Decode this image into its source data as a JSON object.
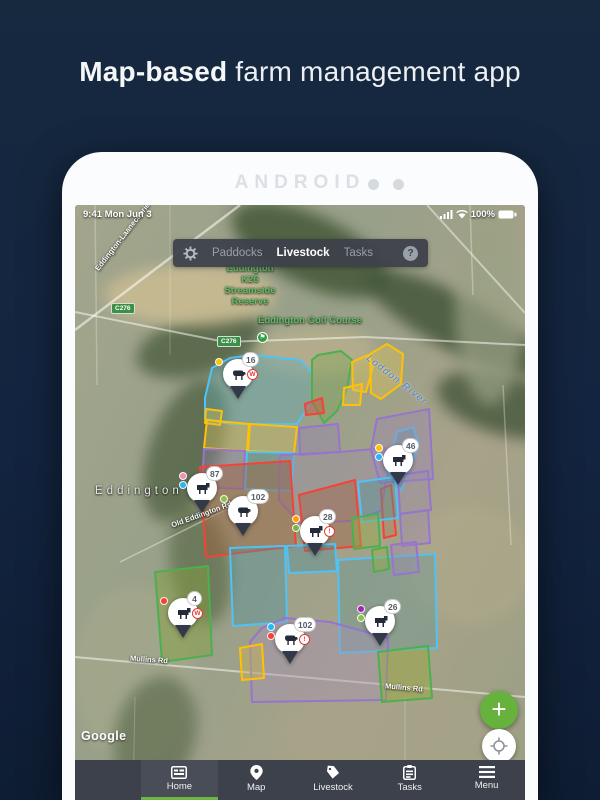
{
  "page": {
    "title_bold": "Map-based",
    "title_rest": " farm management app"
  },
  "device": {
    "brand": "ANDROID"
  },
  "status_bar": {
    "time_date": "9:41  Mon Jun 3",
    "battery_pct": "100%"
  },
  "top_nav": {
    "help": "?",
    "tabs": [
      {
        "label": "Paddocks",
        "active": false
      },
      {
        "label": "Livestock",
        "active": true
      },
      {
        "label": "Tasks",
        "active": false
      }
    ]
  },
  "map": {
    "labels": {
      "reserve_lines": [
        "Eddington",
        "K26",
        "Streamside",
        "Reserve"
      ],
      "golf_course": "Eddington Golf Course",
      "road_shield_1": "C276",
      "road_shield_2": "C276",
      "road_laanecoorie": "Eddington-Laanecoorie Rd",
      "river": "Loddon River",
      "place": "Eddington",
      "road_old_eddington": "Old Eddington Rd",
      "road_mullins_1": "Mullins Rd",
      "road_mullins_2": "Mullins Rd",
      "attribution": "Google"
    },
    "palette": {
      "cyan": "#4FC3F7",
      "green": "#4CAF50",
      "yellow": "#FFC107",
      "purple": "#9575CD",
      "red": "#F44336"
    },
    "paddocks": [
      {
        "points": "130,193 137,163 155,153 177,150 225,155 237,168 237,196 222,219 156,219 130,214",
        "stroke": "cyan",
        "fill": "rgba(100,170,180,0.40)"
      },
      {
        "points": "237,168 237,155 243,150 266,146 277,155 272,184 262,206 249,218 237,196",
        "stroke": "green",
        "fill": "rgba(120,165,75,0.35)"
      },
      {
        "points": "277,157 293,150 298,162 291,187 278,185",
        "stroke": "yellow",
        "fill": "rgba(210,190,90,0.45)"
      },
      {
        "points": "295,149 312,139 328,149 326,179 306,194 296,188",
        "stroke": "yellow",
        "fill": "rgba(210,190,90,0.45)"
      },
      {
        "points": "269,183 287,179 285,200 268,200",
        "stroke": "yellow",
        "fill": "rgba(210,190,90,0.40)"
      },
      {
        "points": "230,199 247,193 249,208 231,210",
        "stroke": "red",
        "fill": "rgba(200,90,70,0.50)"
      },
      {
        "points": "131,204 147,206 145,220 130,218",
        "stroke": "yellow",
        "fill": "rgba(210,190,90,0.40)"
      },
      {
        "points": "132,215 174,219 172,246 129,243",
        "stroke": "yellow",
        "fill": "rgba(205,185,95,0.45)"
      },
      {
        "points": "175,219 222,222 219,248 173,246",
        "stroke": "yellow",
        "fill": "rgba(205,185,95,0.45)"
      },
      {
        "points": "224,223 263,219 265,247 225,250",
        "stroke": "purple",
        "fill": "rgba(150,130,185,0.38)"
      },
      {
        "points": "129,244 170,246 168,284 127,282",
        "stroke": "purple",
        "fill": "rgba(150,130,185,0.32)"
      },
      {
        "points": "172,247 219,248 217,286 170,284",
        "stroke": "cyan",
        "fill": "rgba(80,145,155,0.42)"
      },
      {
        "points": "205,250 265,247 310,243 313,266 306,306 274,316 224,318 204,295",
        "stroke": "purple",
        "fill": "rgba(155,135,175,0.35)"
      },
      {
        "points": "322,227 338,222 344,240 326,286 312,266",
        "stroke": "cyan",
        "fill": "rgba(80,145,155,0.40)"
      },
      {
        "points": "302,214 354,204 358,274 305,278 296,245",
        "stroke": "purple",
        "fill": "rgba(155,135,180,0.42)"
      },
      {
        "points": "125,262 215,256 221,341 131,352",
        "stroke": "red",
        "fill": "rgba(160,95,60,0.45)"
      },
      {
        "points": "224,290 280,275 286,341 230,346",
        "stroke": "red",
        "fill": "rgba(160,95,60,0.40)"
      },
      {
        "points": "306,284 316,280 321,330 309,333",
        "stroke": "red",
        "fill": "rgba(180,120,80,0.35)"
      },
      {
        "points": "283,277 320,272 323,313 287,317",
        "stroke": "cyan",
        "fill": "rgba(80,145,155,0.40)"
      },
      {
        "points": "323,270 353,266 356,305 325,309",
        "stroke": "purple",
        "fill": "rgba(155,135,180,0.35)"
      },
      {
        "points": "277,313 303,309 305,341 279,344",
        "stroke": "green",
        "fill": "rgba(150,170,70,0.45)"
      },
      {
        "points": "325,309 353,305 355,338 327,341",
        "stroke": "purple",
        "fill": "rgba(155,135,180,0.35)"
      },
      {
        "points": "155,343 210,341 212,417 158,421",
        "stroke": "cyan",
        "fill": "rgba(80,145,155,0.40)"
      },
      {
        "points": "212,341 260,339 262,366 214,368",
        "stroke": "cyan",
        "fill": "rgba(80,145,155,0.38)"
      },
      {
        "points": "263,355 360,349 362,443 265,448",
        "stroke": "cyan",
        "fill": "rgba(90,150,150,0.35)"
      },
      {
        "points": "297,345 312,342 314,364 299,367",
        "stroke": "green",
        "fill": "rgba(150,170,70,0.45)"
      },
      {
        "points": "316,340 341,337 344,367 319,370",
        "stroke": "purple",
        "fill": "rgba(155,135,180,0.35)"
      },
      {
        "points": "80,367 133,361 137,450 87,457",
        "stroke": "green",
        "fill": "rgba(130,160,60,0.45)"
      },
      {
        "points": "175,437 187,423 210,413 255,417 313,433 311,495 177,497",
        "stroke": "purple",
        "fill": "rgba(165,145,185,0.40)"
      },
      {
        "points": "303,447 353,441 357,493 307,497",
        "stroke": "green",
        "fill": "rgba(150,170,60,0.48)"
      },
      {
        "points": "165,443 187,439 189,473 167,475",
        "stroke": "yellow",
        "fill": "rgba(200,180,80,0.45)"
      }
    ],
    "roads": [
      {
        "points": "0,125 165,0",
        "o": 0.55,
        "w": 2.5
      },
      {
        "points": "0,107 150,137 290,132 450,140",
        "o": 0.5,
        "w": 2
      },
      {
        "points": "352,0 450,108",
        "o": 0.45,
        "w": 2
      },
      {
        "points": "0,452 450,492",
        "o": 0.5,
        "w": 2
      },
      {
        "points": "45,357 160,300",
        "o": 0.4,
        "w": 1.5
      },
      {
        "points": "20,0 22,180",
        "o": 0.25,
        "w": 1.5
      },
      {
        "points": "95,0 95,150",
        "o": 0.22,
        "w": 1
      },
      {
        "points": "395,0 398,90",
        "o": 0.3,
        "w": 1.5
      },
      {
        "points": "428,180 436,340",
        "o": 0.3,
        "w": 1.5
      },
      {
        "points": "330,492 330,595",
        "o": 0.25,
        "w": 1
      },
      {
        "points": "60,492 58,595",
        "o": 0.22,
        "w": 1
      }
    ],
    "markers": [
      {
        "count": "16",
        "animal": "sheep",
        "x": 163,
        "y": 172,
        "dots": [
          "#FFC107"
        ],
        "alert": {
          "text": "W",
          "color": "#E53935"
        }
      },
      {
        "count": "46",
        "animal": "cow",
        "x": 323,
        "y": 258,
        "dots": [
          "#FFC107",
          "#29B6F6"
        ]
      },
      {
        "count": "87",
        "animal": "cow",
        "x": 127,
        "y": 286,
        "dots": [
          "#F48FB1",
          "#29B6F6"
        ]
      },
      {
        "count": "102",
        "animal": "sheep",
        "x": 168,
        "y": 309,
        "dots": [
          "#8BC34A"
        ]
      },
      {
        "count": "28",
        "animal": "cow",
        "x": 240,
        "y": 329,
        "dots": [
          "#FFA000",
          "#7CB342"
        ],
        "alert": {
          "text": "!",
          "color": "#E53935"
        }
      },
      {
        "count": "4",
        "animal": "cow",
        "x": 108,
        "y": 411,
        "dots": [
          "#F44336"
        ],
        "alert": {
          "text": "W",
          "color": "#E53935"
        }
      },
      {
        "count": "26",
        "animal": "cow",
        "x": 305,
        "y": 419,
        "dots": [
          "#9C27B0",
          "#8BC34A"
        ]
      },
      {
        "count": "102",
        "animal": "sheep",
        "x": 215,
        "y": 437,
        "dots": [
          "#29B6F6",
          "#F44336"
        ],
        "alert": {
          "text": "!",
          "color": "#E53935"
        }
      }
    ]
  },
  "fabs": {
    "add": "+"
  },
  "bottom_nav": {
    "items": [
      {
        "label": "Home",
        "active": true
      },
      {
        "label": "Map",
        "active": false
      },
      {
        "label": "Livestock",
        "active": false
      },
      {
        "label": "Tasks",
        "active": false
      },
      {
        "label": "Menu",
        "active": false
      }
    ]
  }
}
